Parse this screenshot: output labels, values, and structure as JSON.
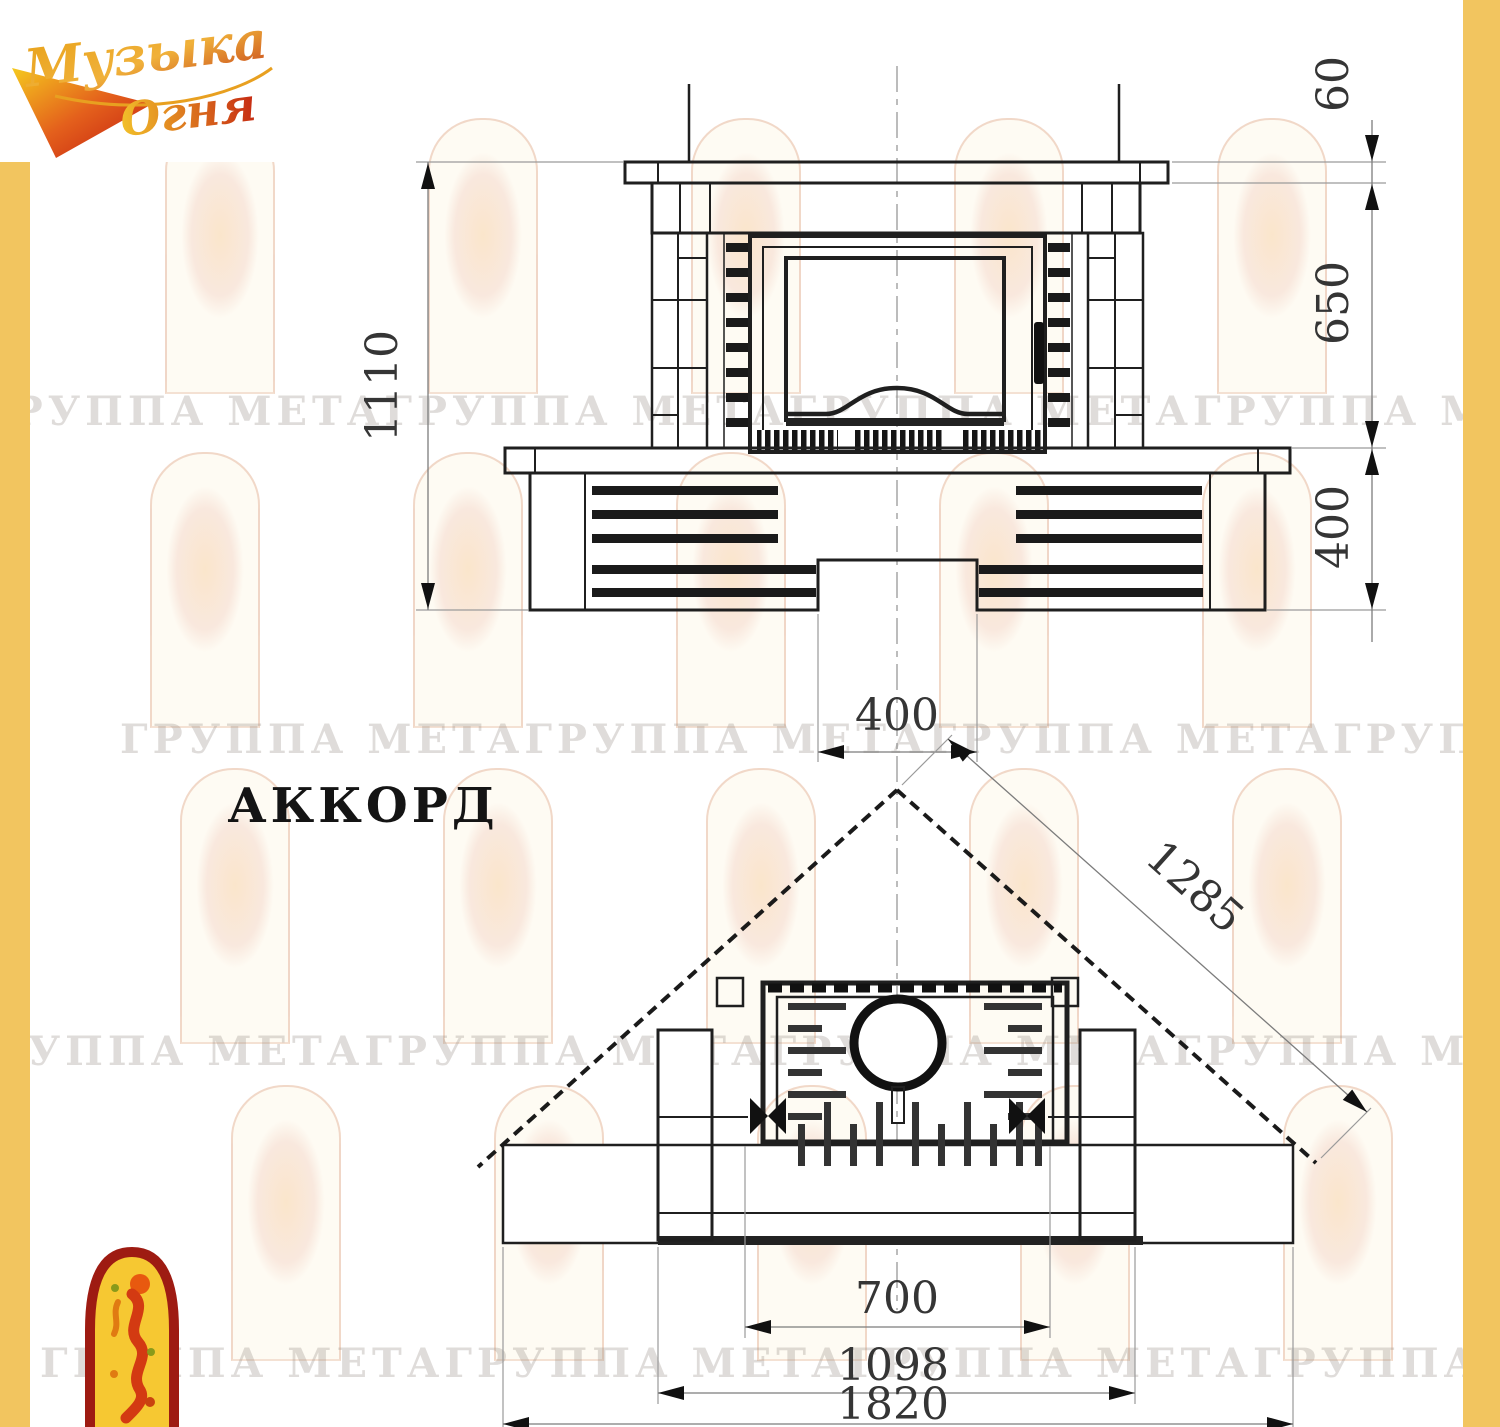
{
  "brand": {
    "line1": "Музыка",
    "line2": "Огня"
  },
  "title": "АККОРД",
  "watermark": {
    "row_text": "ГРУППА МЕТАГРУППА МЕТАГРУППА МЕТАГРУППА МЕТАГРУППА МЕТА"
  },
  "front_view": {
    "dims": {
      "height": "1110",
      "mantel": "60",
      "opening": "650",
      "base": "400",
      "notch": "400"
    }
  },
  "plan_view": {
    "dims": {
      "diagonal": "1285",
      "opening": "700",
      "body": "1098",
      "overall": "1820"
    }
  },
  "colors": {
    "accent_yellow": "#f2c55f",
    "logo_red": "#a32015",
    "line_dark": "#1f1f1f"
  }
}
